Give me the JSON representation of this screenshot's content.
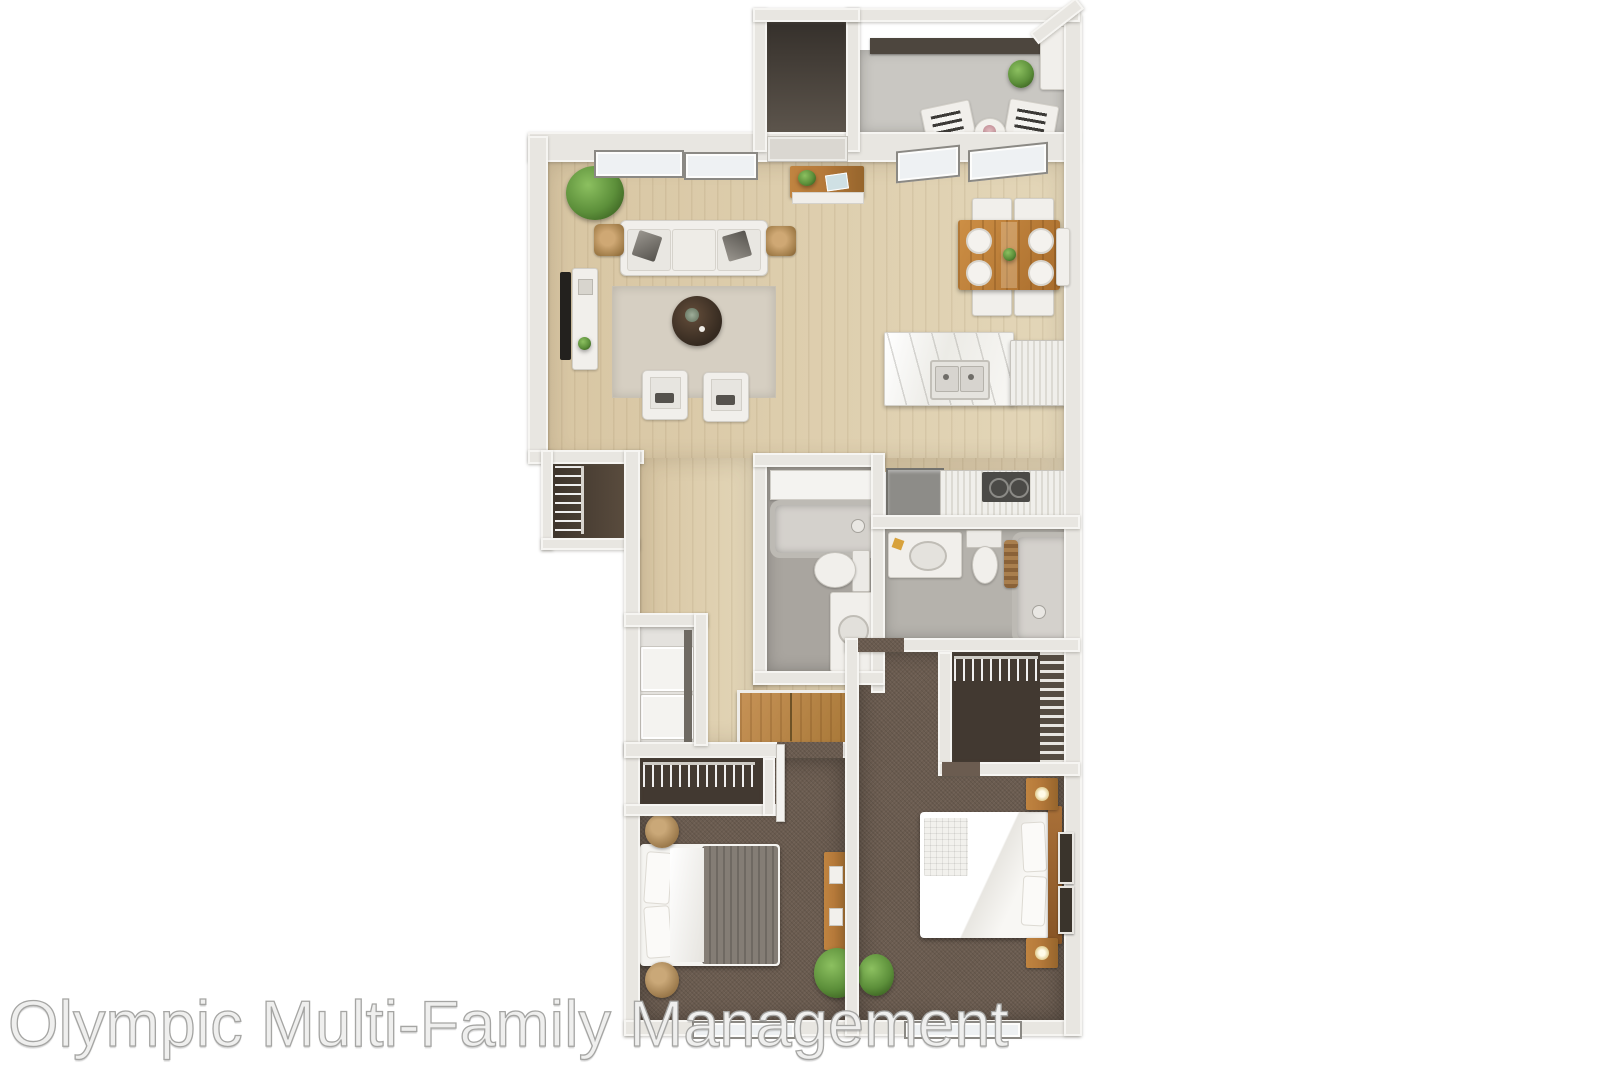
{
  "watermark": {
    "text": "Olympic Multi-Family Management"
  },
  "palette": {
    "wall": "#e8e6e1",
    "wall_edge_hi": "#f6f5f2",
    "wood": "#d8c6a3",
    "wood_light": "#e3d6b8",
    "carpet": "#6b5c50",
    "carpet_dark": "#423931",
    "rug": "#d6cfc2",
    "balcony_floor": "#c9c7c2",
    "entry_top": "#35302b",
    "entry_bottom": "#60584f",
    "bath_floor": "#a9a59f",
    "bath2_floor": "#b5b2ac",
    "laundry_floor": "#e4e2de",
    "furn_white": "#f1efeb",
    "furn_wood": "#b5793a",
    "dark_table": "#352a20",
    "plant": "#5c8f3a",
    "appliance": "#8d8c88",
    "cooktop": "#4b4a47",
    "tv": "#23211e",
    "blanket": "#847d75",
    "rail": "#4d463e",
    "window_glass": "#eef1f3",
    "window_frame": "#8b8984",
    "watermark_fill": "#efefee",
    "watermark_stroke": "#a5a5a3"
  }
}
